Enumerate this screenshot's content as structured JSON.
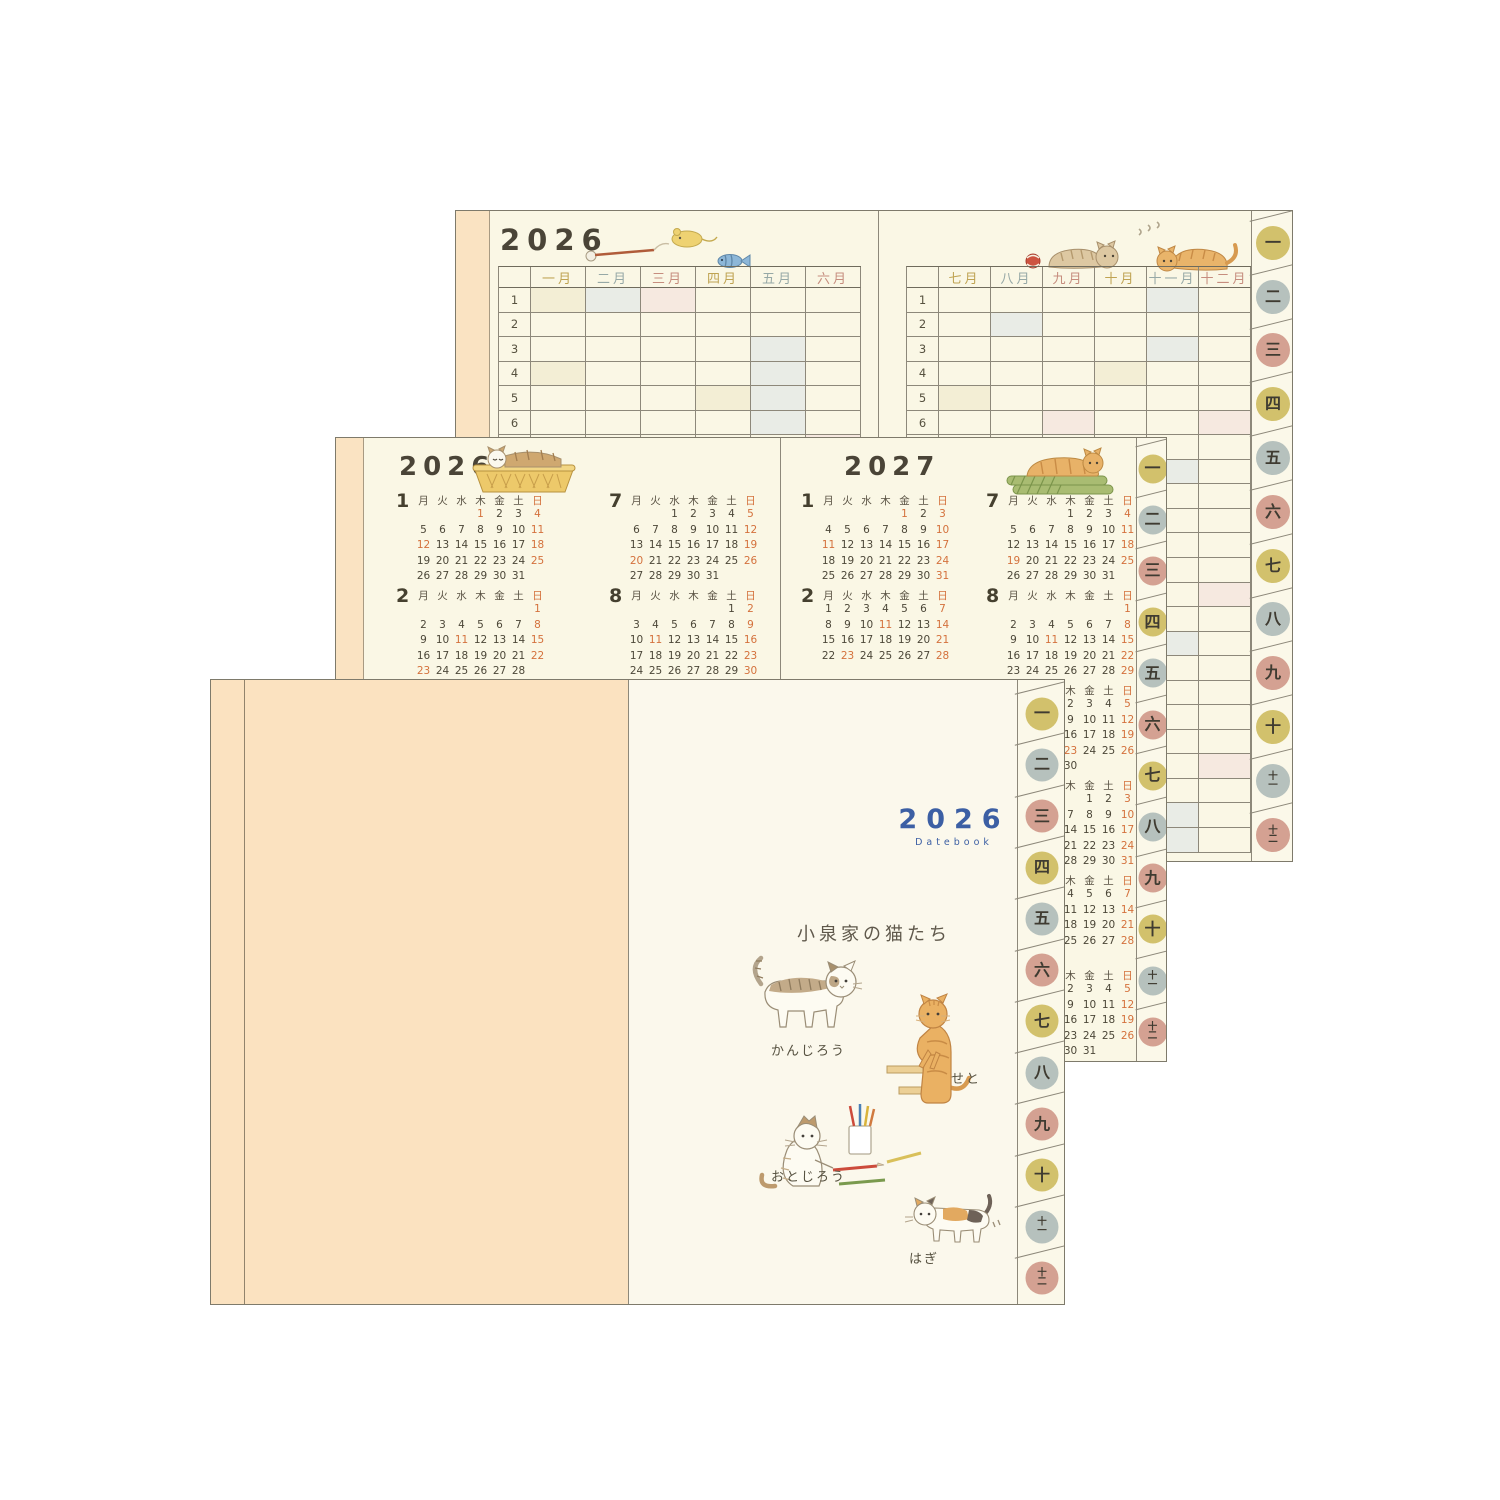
{
  "colors": {
    "paper": "#faf7e5",
    "peach": "#fae3c2",
    "line": "#8d887a",
    "ink": "#474234",
    "date_red": "#d4713c",
    "title_blue": "#3c5fa4",
    "cycle_text": [
      "#bfa352",
      "#96a8a6",
      "#c68d7e"
    ],
    "cycle_fill": [
      "#f3eed5",
      "#e9ece6",
      "#f6e9e0"
    ],
    "cycle_tab": [
      "#d2c16c",
      "#b6c1bd",
      "#d4a192"
    ]
  },
  "tabs": {
    "labels": [
      "一",
      "二",
      "三",
      "四",
      "五",
      "六",
      "七",
      "八",
      "九",
      "十",
      "十一",
      "十二"
    ]
  },
  "yearly": {
    "title": "2026",
    "left_months": [
      "一月",
      "二月",
      "三月",
      "四月",
      "五月",
      "六月"
    ],
    "right_months": [
      "七月",
      "八月",
      "九月",
      "十月",
      "十一月",
      "十二月"
    ],
    "rows": 23,
    "shaded_left": [
      [
        1,
        4,
        11,
        12,
        18
      ],
      [
        1,
        8,
        11,
        15,
        22,
        23
      ],
      [
        1,
        8,
        15,
        20,
        22
      ],
      [
        5,
        12,
        19
      ],
      [
        3,
        4,
        5,
        6,
        10,
        17
      ],
      [
        7,
        14,
        21
      ]
    ],
    "shaded_right": [
      [
        5,
        12,
        19,
        20
      ],
      [
        2,
        9,
        11,
        16,
        23
      ],
      [
        6,
        13,
        20,
        21,
        22,
        23
      ],
      [
        4,
        11,
        12,
        18
      ],
      [
        1,
        3,
        8,
        15,
        22,
        23
      ],
      [
        6,
        13,
        20
      ]
    ]
  },
  "mini": {
    "weekdays": [
      "月",
      "火",
      "水",
      "木",
      "金",
      "土",
      "日"
    ],
    "pages": [
      {
        "title": "2026",
        "months": [
          {
            "n": "1",
            "start": 3,
            "days": 31,
            "holidays": [
              1,
              12
            ]
          },
          {
            "n": "2",
            "start": 6,
            "days": 28,
            "holidays": [
              11,
              23
            ]
          },
          {
            "n": "3",
            "start": 6,
            "days": 31,
            "holidays": [
              20
            ]
          },
          {
            "n": "4",
            "start": 2,
            "days": 30,
            "holidays": [
              29
            ]
          },
          {
            "n": "5",
            "start": 4,
            "days": 31,
            "holidays": [
              3,
              4,
              5,
              6
            ]
          },
          {
            "n": "6",
            "start": 0,
            "days": 30,
            "holidays": []
          },
          {
            "n": "7",
            "start": 2,
            "days": 31,
            "holidays": [
              20
            ]
          },
          {
            "n": "8",
            "start": 5,
            "days": 31,
            "holidays": [
              11
            ]
          },
          {
            "n": "9",
            "start": 1,
            "days": 30,
            "holidays": [
              21,
              22,
              23
            ]
          },
          {
            "n": "10",
            "start": 3,
            "days": 31,
            "holidays": [
              12
            ]
          },
          {
            "n": "11",
            "start": 6,
            "days": 30,
            "holidays": [
              3,
              23
            ]
          },
          {
            "n": "12",
            "start": 1,
            "days": 31,
            "holidays": []
          }
        ]
      },
      {
        "title": "2027",
        "months": [
          {
            "n": "1",
            "start": 4,
            "days": 31,
            "holidays": [
              1,
              11
            ]
          },
          {
            "n": "2",
            "start": 0,
            "days": 28,
            "holidays": [
              11,
              23
            ]
          },
          {
            "n": "3",
            "start": 0,
            "days": 31,
            "holidays": [
              22
            ]
          },
          {
            "n": "4",
            "start": 3,
            "days": 30,
            "holidays": [
              29
            ]
          },
          {
            "n": "5",
            "start": 5,
            "days": 31,
            "holidays": [
              3,
              4,
              5
            ]
          },
          {
            "n": "6",
            "start": 1,
            "days": 30,
            "holidays": []
          },
          {
            "n": "7",
            "start": 3,
            "days": 31,
            "holidays": [
              19
            ]
          },
          {
            "n": "8",
            "start": 6,
            "days": 31,
            "holidays": [
              11
            ]
          },
          {
            "n": "9",
            "start": 2,
            "days": 30,
            "holidays": [
              20,
              23
            ]
          },
          {
            "n": "10",
            "start": 4,
            "days": 31,
            "holidays": [
              11
            ]
          },
          {
            "n": "11",
            "start": 0,
            "days": 30,
            "holidays": [
              3,
              23
            ]
          },
          {
            "n": "12",
            "start": 2,
            "days": 31,
            "holidays": []
          }
        ]
      }
    ]
  },
  "cover": {
    "year": "2026",
    "subtitle": "Datebook",
    "heading": "小泉家の猫たち",
    "cats": [
      "かんじろう",
      "せと",
      "おとじろう",
      "はぎ"
    ]
  }
}
